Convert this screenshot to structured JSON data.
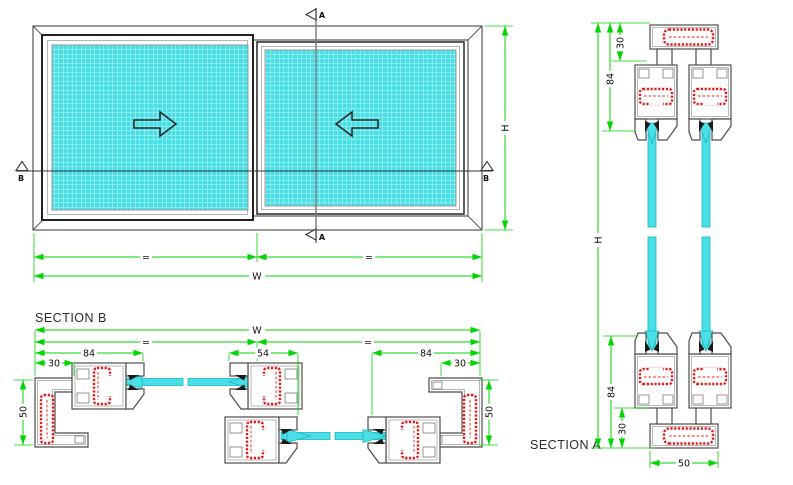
{
  "drawing": {
    "elevation": {
      "height_label": "H",
      "width_label": "W",
      "equal_left": "=",
      "equal_right": "=",
      "cut_a": "A",
      "cut_b": "B"
    },
    "section_b": {
      "title": "SECTION B",
      "total_width": "W",
      "equal_left": "=",
      "equal_right": "=",
      "sash_left": "84",
      "interlock": "54",
      "sash_right": "84",
      "frame_left": "30",
      "frame_right": "30",
      "depth_left": "50",
      "depth_right": "50"
    },
    "section_a": {
      "title": "SECTION A",
      "frame_top": "30",
      "sash_top": "84",
      "total_height": "H",
      "sash_bottom": "84",
      "frame_bottom": "30",
      "sill_width": "50"
    }
  },
  "colors": {
    "dimension_green": "#00d600",
    "glass_cyan": "#45dfe5",
    "insulation_red": "#e81818",
    "profile_outline": "#4d4d4d",
    "background": "#ffffff"
  }
}
